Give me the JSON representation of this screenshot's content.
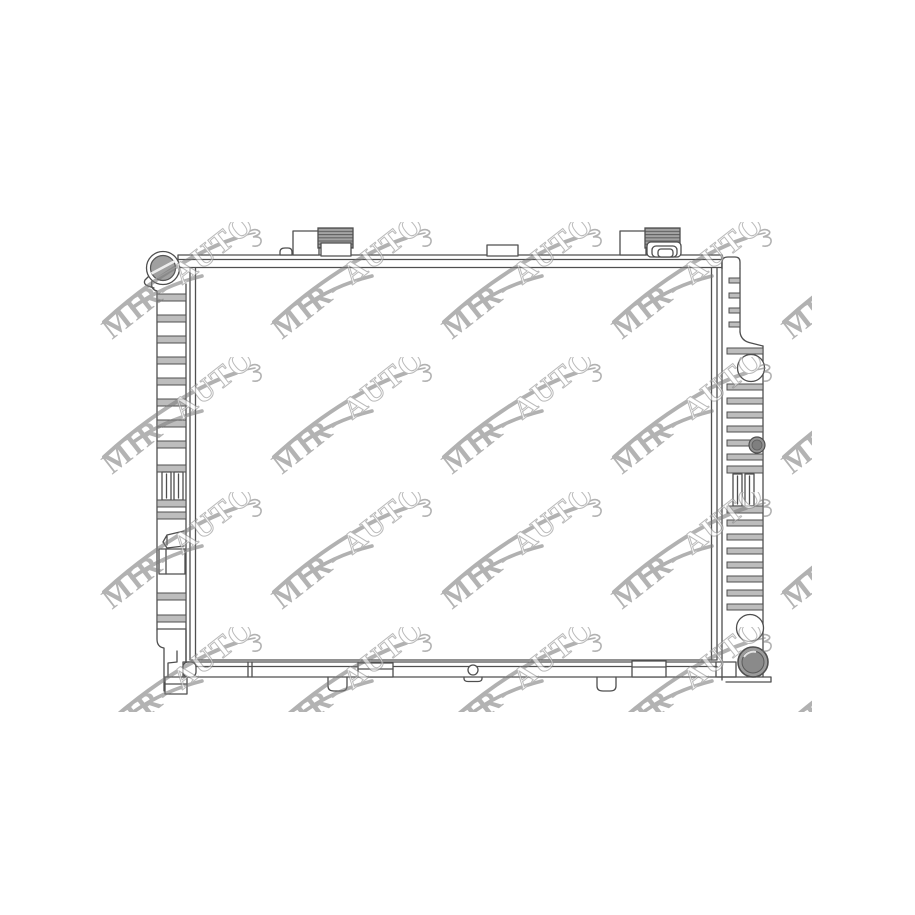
{
  "image": {
    "background_color": "#ffffff",
    "content_label": "radiator technical line drawing"
  },
  "drawing": {
    "line_color": "#4f4f4f",
    "fin_fill": "#bdbdbd",
    "hatch_fill": "#a3a3a3",
    "hatch_line": "#606060",
    "cap_fill": "#a0a0a0",
    "port_fill": "#949494"
  },
  "watermark": {
    "brand": "MIR-AUTO",
    "brand_part1": "MIR-",
    "brand_part2": "AUTO",
    "opacity": 0.58,
    "colors": {
      "swoosh": "#7a7a7a",
      "text_solid": "#7e7e7e",
      "text_outline": "#8a8a8a",
      "text_fill": "#ffffff"
    },
    "grid": {
      "cols": 5,
      "rows": 4,
      "col_spacing": 170,
      "row_spacing": 135,
      "origin_x": 98,
      "origin_y": 222,
      "container_left": 46,
      "container_top": 208
    }
  }
}
